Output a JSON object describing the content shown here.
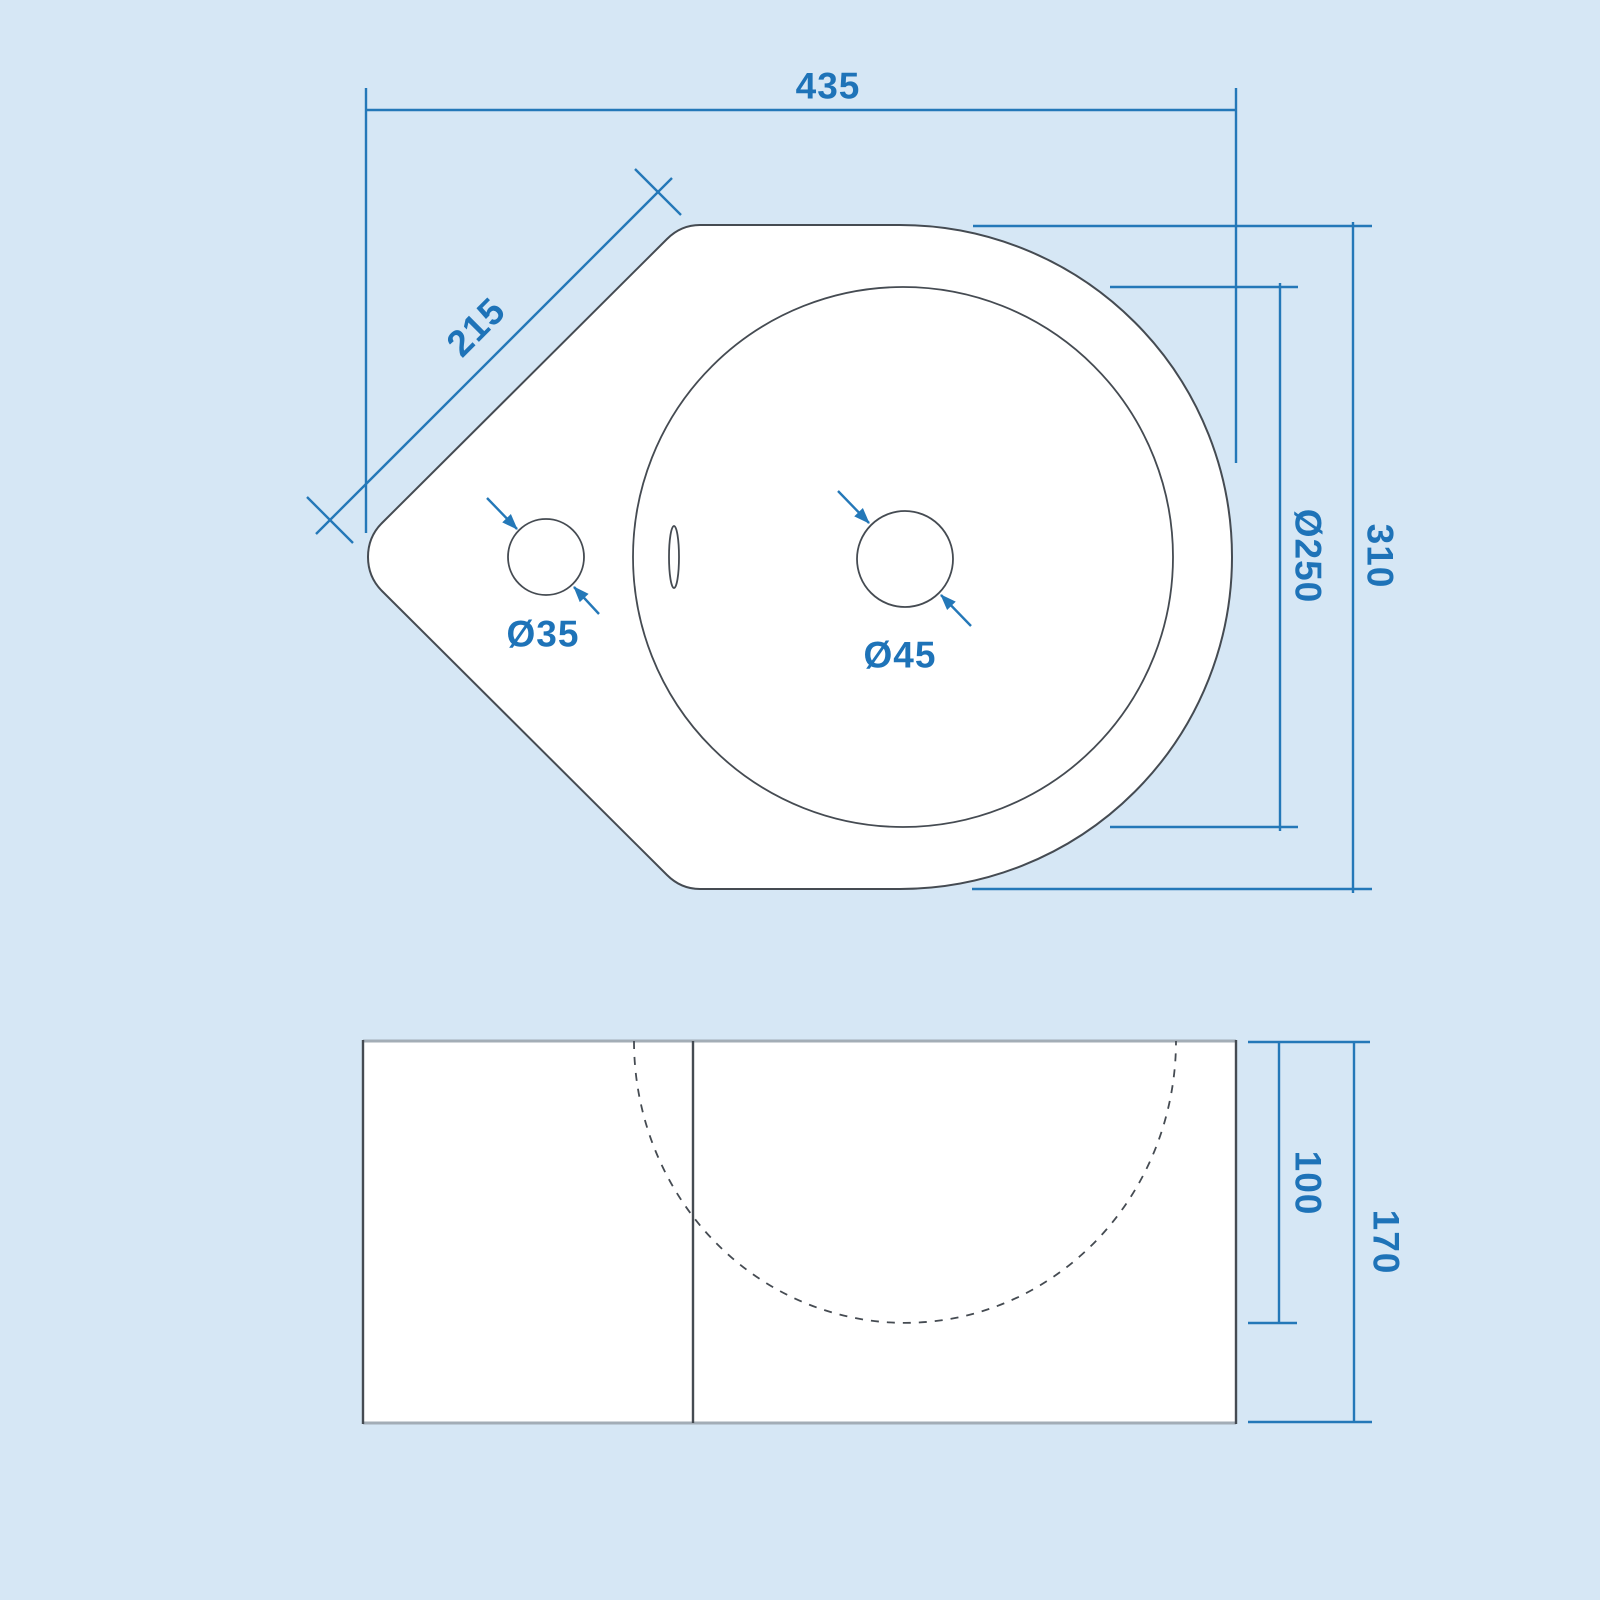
{
  "drawing": {
    "title": "corner-basin-technical-drawing",
    "views": {
      "top_view": {
        "dimensions": {
          "overall_width": {
            "label": "435"
          },
          "corner_edge": {
            "label": "215"
          },
          "bowl_diameter": {
            "label": "Ø250"
          },
          "overall_depth": {
            "label": "310"
          },
          "tap_hole_diameter": {
            "label": "Ø35"
          },
          "waste_hole_diameter": {
            "label": "Ø45"
          }
        }
      },
      "front_view": {
        "dimensions": {
          "bowl_depth": {
            "label": "100"
          },
          "overall_height": {
            "label": "170"
          }
        }
      }
    },
    "colors": {
      "background": "#d6e7f5",
      "surface": "#ffffff",
      "outline": "#454b52",
      "outline_light": "#a3adb6",
      "dimension": "#2478b8",
      "dimension_text": "#1e73b8"
    }
  }
}
